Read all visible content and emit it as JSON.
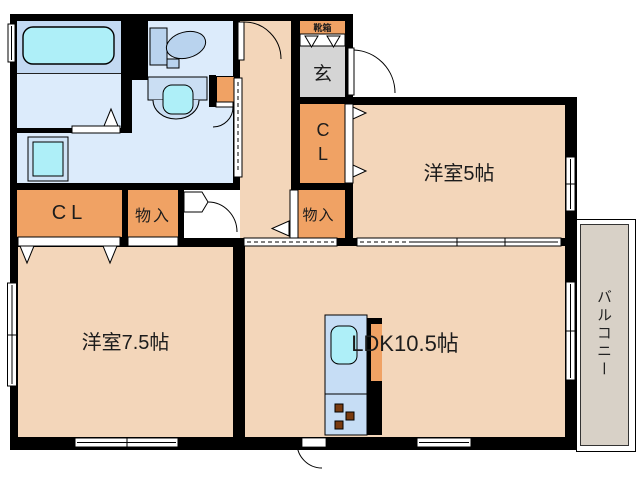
{
  "title": "間取り図",
  "colors": {
    "wall": "#000000",
    "room": "#f3d6ba",
    "closet": "#f0a264",
    "entry": "#d5d5d5",
    "balcony": "#d8d1c7",
    "bath": "#c3d9f2",
    "water": "#dcebfb",
    "fixture": "#b9d3ee",
    "cyan": "#aeeff8",
    "kitchen": "#c6ddf5",
    "counter": "#cadef3",
    "pan": "#cfe3f6",
    "burner": "#7a3b10"
  },
  "rooms": {
    "shoe_box": {
      "label": "靴箱"
    },
    "entrance": {
      "label": "玄"
    },
    "closet_main": {
      "label": "CL"
    },
    "storage_1": {
      "label": "物入"
    },
    "closet_5": {
      "label": "CL"
    },
    "storage_2": {
      "label": "物入"
    },
    "west_room_5": {
      "label": "洋室5帖"
    },
    "west_room_7_5": {
      "label": "洋室7.5帖"
    },
    "ldk": {
      "label": "LDK10.5帖"
    },
    "balcony": {
      "label": "バルコニー"
    }
  }
}
